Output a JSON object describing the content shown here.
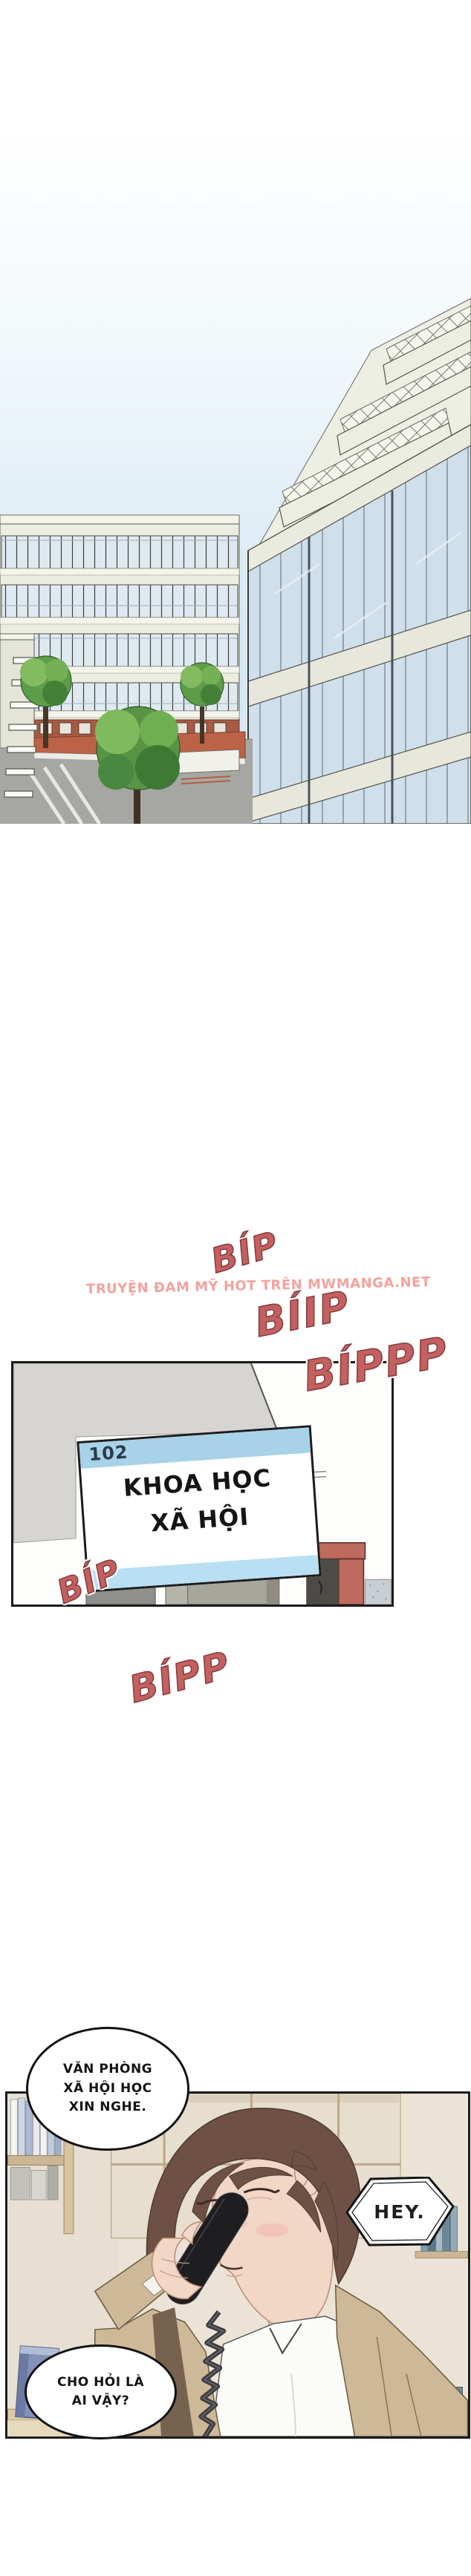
{
  "sfx": {
    "beep1": "BÍP",
    "beep2": "BÍIP",
    "beep3": "BÍPPP",
    "beep4": "BÍP",
    "beep5": "BÍPP"
  },
  "watermark": {
    "text": "TRUYỆN ĐAM MỸ HOT TRÊN MWMANGA.NET"
  },
  "sign": {
    "room_number": "102",
    "title_line1": "KHOA HỌC",
    "title_line2": "XÃ HỘI"
  },
  "bubbles": {
    "office_greeting": {
      "line1": "VĂN PHÒNG",
      "line2": "XÃ HỘI HỌC",
      "line3": "XIN NGHE."
    },
    "hey": {
      "text": "HEY."
    },
    "who_question": {
      "line1": "CHO HỎI LÀ",
      "line2": "AI VẬY?"
    }
  },
  "colors": {
    "sfx-red": "#c46060",
    "sfx-outline": "#833b3b",
    "watermark-pink": "#f3a29d",
    "sign-blue-top": "#a7d2e8",
    "sign-blue-bottom": "#b9dff2",
    "sign-number-navy": "#2b3b4e",
    "panel-border": "#1b1b1b",
    "bubble-border": "#121212",
    "sky-blue": "#d7e9f3",
    "building-cream": "#ecede1",
    "glass-blue": "#cfdfec",
    "tree-green": "#5d9c49",
    "walkway-terracotta": "#bc6247",
    "door-red": "#bf6a5e",
    "hair-brown": "#6e5144",
    "skin-tone": "#f2d6c6",
    "jacket-tan": "#cdb897",
    "phone-black": "#1e1e21"
  }
}
